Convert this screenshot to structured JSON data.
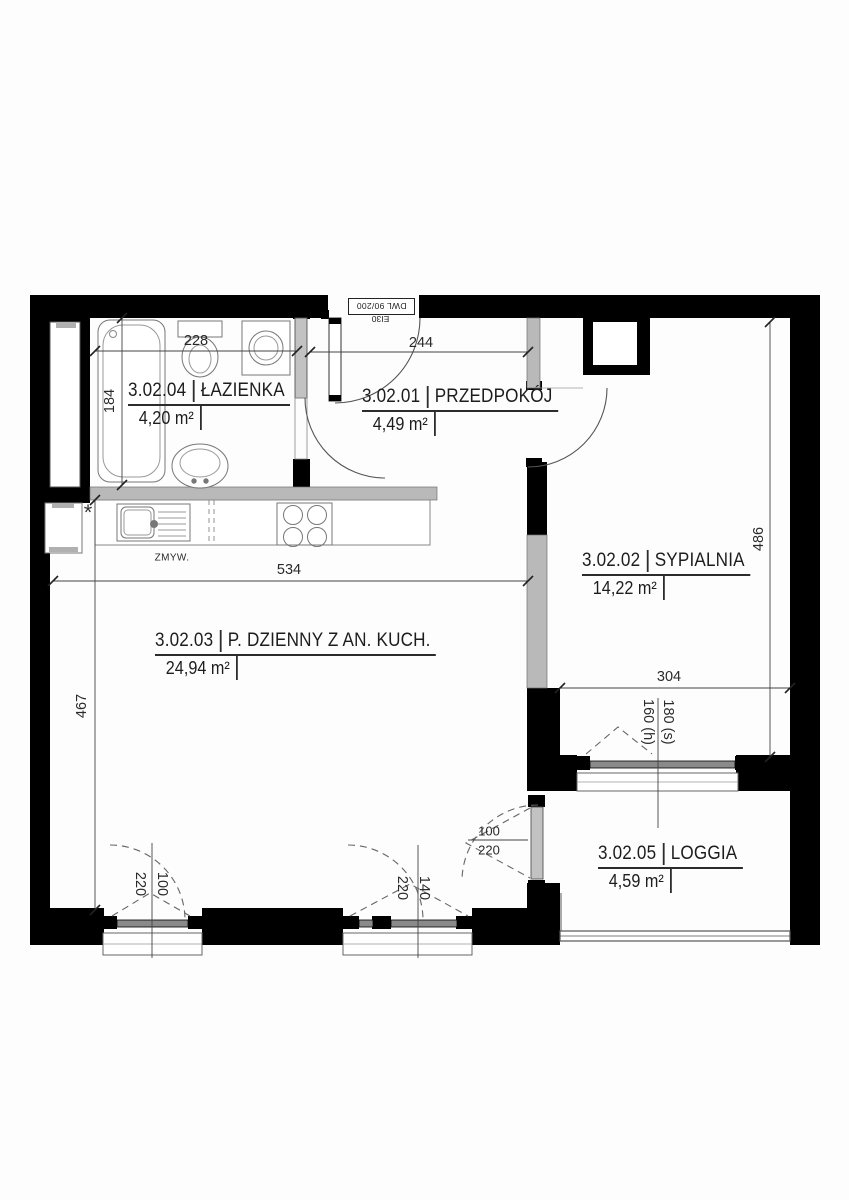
{
  "plan": {
    "rooms": [
      {
        "number": "3.02.04",
        "name": "ŁAZIENKA",
        "area": "4,20 m²"
      },
      {
        "number": "3.02.01",
        "name": "PRZEDPOKÓJ",
        "area": "4,49 m²"
      },
      {
        "number": "3.02.02",
        "name": "SYPIALNIA",
        "area": "14,22 m²"
      },
      {
        "number": "3.02.03",
        "name": "P. DZIENNY Z AN. KUCH.",
        "area": "24,94 m²"
      },
      {
        "number": "3.02.05",
        "name": "LOGGIA",
        "area": "4,59 m²"
      }
    ],
    "dimensions": {
      "bathroom_width": "228",
      "hall_width": "244",
      "bathroom_depth": "184",
      "kitchen_wall_width": "534",
      "living_depth": "467",
      "bedroom_depth": "486",
      "bedroom_width": "304",
      "bedroom_window_width": "180 (s)",
      "bedroom_window_height": "160 (h)",
      "left_window_height": "220",
      "left_window_width": "100",
      "mid_window_height": "220",
      "mid_window_width": "140",
      "loggia_door_width": "100",
      "loggia_door_height": "220"
    },
    "entrance_door": {
      "type": "DWL 90/200",
      "fire_rating": "EI30"
    },
    "labels": {
      "dishwasher": "ZMYW.",
      "note_symbol": "*"
    }
  }
}
